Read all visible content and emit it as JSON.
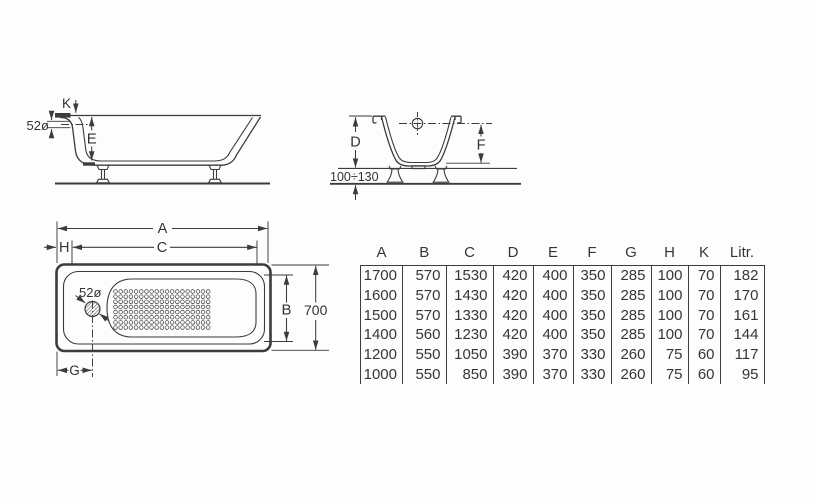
{
  "views": {
    "side": {
      "labels": {
        "k": "K",
        "e": "E",
        "overflow_diameter": "52ø"
      }
    },
    "section": {
      "labels": {
        "d": "D",
        "f": "F",
        "leg_height_range": "100÷130"
      }
    },
    "top": {
      "labels": {
        "a": "A",
        "h": "H",
        "c": "C",
        "b": "B",
        "g": "G",
        "overall_width": "700",
        "drain_diameter": "52ø"
      }
    }
  },
  "table": {
    "headers": [
      "A",
      "B",
      "C",
      "D",
      "E",
      "F",
      "G",
      "H",
      "K",
      "Litr."
    ],
    "rows": [
      [
        "1700",
        "570",
        "1530",
        "420",
        "400",
        "350",
        "285",
        "100",
        "70",
        "182"
      ],
      [
        "1600",
        "570",
        "1430",
        "420",
        "400",
        "350",
        "285",
        "100",
        "70",
        "170"
      ],
      [
        "1500",
        "570",
        "1330",
        "420",
        "400",
        "350",
        "285",
        "100",
        "70",
        "161"
      ],
      [
        "1400",
        "560",
        "1230",
        "420",
        "400",
        "350",
        "285",
        "100",
        "70",
        "144"
      ],
      [
        "1200",
        "550",
        "1050",
        "390",
        "370",
        "330",
        "260",
        "75",
        "60",
        "117"
      ],
      [
        "1000",
        "550",
        "850",
        "390",
        "370",
        "330",
        "260",
        "75",
        "60",
        "95"
      ]
    ]
  },
  "colors": {
    "line": "#3c3c3c",
    "text": "#333333",
    "background": "#fdfdfd"
  }
}
